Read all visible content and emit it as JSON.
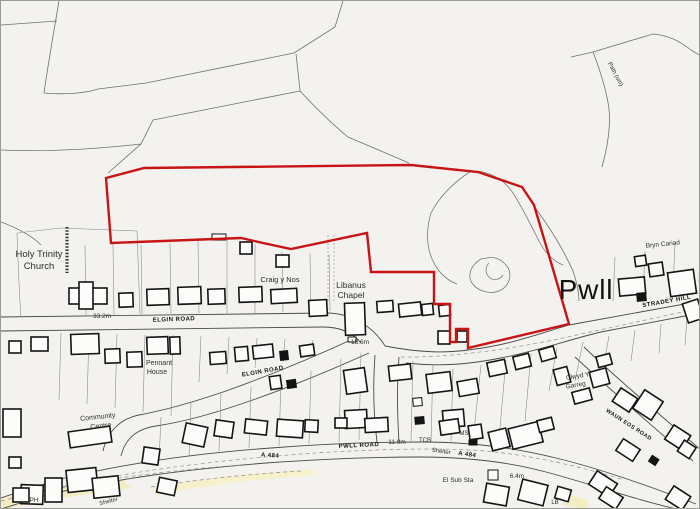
{
  "colors": {
    "boundary": "#c81414",
    "building": "#141414",
    "background": "#f3f2ef",
    "road_tint": "#f3ecbf"
  },
  "labels": {
    "place": {
      "holy_trinity_1": "Holy Trinity",
      "holy_trinity_2": "Church",
      "craig_y_nos": "Craig y Nos",
      "libanus_1": "Libanus",
      "libanus_2": "Chapel",
      "pennant_1": "Pennant",
      "pennant_2": "House",
      "community_1": "Community",
      "community_2": "Centre",
      "bryn_cariad": "Bryn Cariad",
      "garreg_1": "Clwyd Y",
      "garreg_2": "Garreg",
      "pwll": "Pwll"
    },
    "roads": {
      "elgin_upper": "ELGIN ROAD",
      "elgin_lower": "ELGIN ROAD",
      "pwll_road": "PWLL ROAD",
      "stradey_hill": "STRADEY HILL",
      "waun_eos": "WAUN EOS ROAD",
      "a484_west": "A 484",
      "a484_east": "A 484",
      "path_um": "Path (um)"
    },
    "spot_heights": {
      "h1": "33.2m",
      "h2": "18.6m",
      "h3": "11.9m",
      "h4": "6.4m"
    },
    "features": {
      "tcb": "TCB",
      "shelter_e": "Shelter",
      "shelter_w": "Shelter",
      "ms": "MS",
      "el_sub_sta": "El Sub Sta",
      "ph": "PH",
      "lb": "LB"
    }
  }
}
